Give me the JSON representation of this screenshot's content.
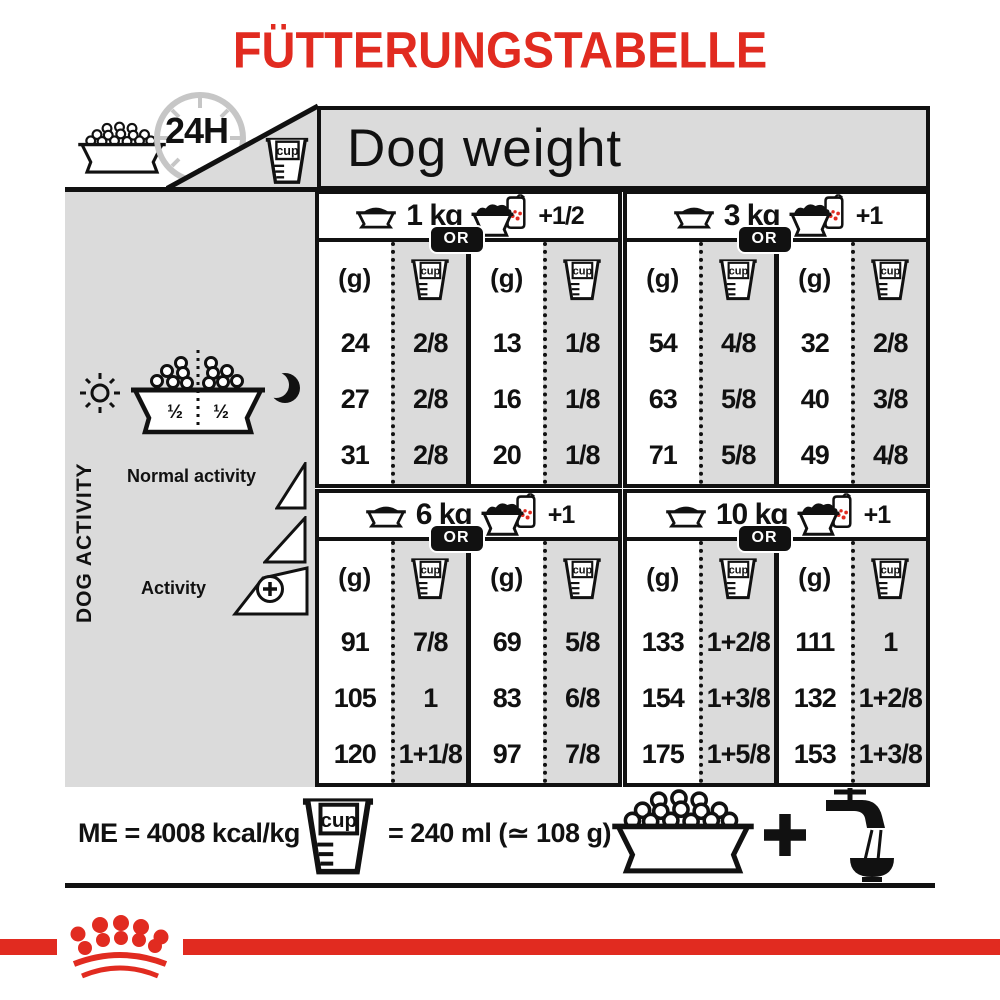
{
  "title": "FÜTTERUNGSTABELLE",
  "header": {
    "clock_label": "24H",
    "dog_weight_label": "Dog weight"
  },
  "cup_label": "cup",
  "sidebar": {
    "bowl_half_left": "½",
    "bowl_half_right": "½",
    "axis_label": "DOG ACTIVITY",
    "normal_activity_label": "Normal activity",
    "activity_label": "Activity"
  },
  "table": {
    "or_label": "OR",
    "grams_header": "(g)",
    "blocks": [
      {
        "weight": "1 kg",
        "extra": "+1/2",
        "dry": {
          "g": [
            "24",
            "27",
            "31"
          ],
          "cups": [
            "2/8",
            "2/8",
            "2/8"
          ]
        },
        "mix": {
          "g": [
            "13",
            "16",
            "20"
          ],
          "cups": [
            "1/8",
            "1/8",
            "1/8"
          ]
        }
      },
      {
        "weight": "3 kg",
        "extra": "+1",
        "dry": {
          "g": [
            "54",
            "63",
            "71"
          ],
          "cups": [
            "4/8",
            "5/8",
            "5/8"
          ]
        },
        "mix": {
          "g": [
            "32",
            "40",
            "49"
          ],
          "cups": [
            "2/8",
            "3/8",
            "4/8"
          ]
        }
      },
      {
        "weight": "6 kg",
        "extra": "+1",
        "dry": {
          "g": [
            "91",
            "105",
            "120"
          ],
          "cups": [
            "7/8",
            "1",
            "1+1/8"
          ]
        },
        "mix": {
          "g": [
            "69",
            "83",
            "97"
          ],
          "cups": [
            "5/8",
            "6/8",
            "7/8"
          ]
        }
      },
      {
        "weight": "10 kg",
        "extra": "+1",
        "dry": {
          "g": [
            "133",
            "154",
            "175"
          ],
          "cups": [
            "1+2/8",
            "1+3/8",
            "1+5/8"
          ]
        },
        "mix": {
          "g": [
            "111",
            "132",
            "153"
          ],
          "cups": [
            "1",
            "1+2/8",
            "1+3/8"
          ]
        }
      }
    ]
  },
  "footer": {
    "me_label": "ME = 4008 kcal/kg",
    "cup_equivalence": "= 240 ml (≃ 108 g)"
  },
  "colors": {
    "brand_red": "#E12B20",
    "panel_gray": "#DBDBDB",
    "ink": "#111111"
  }
}
